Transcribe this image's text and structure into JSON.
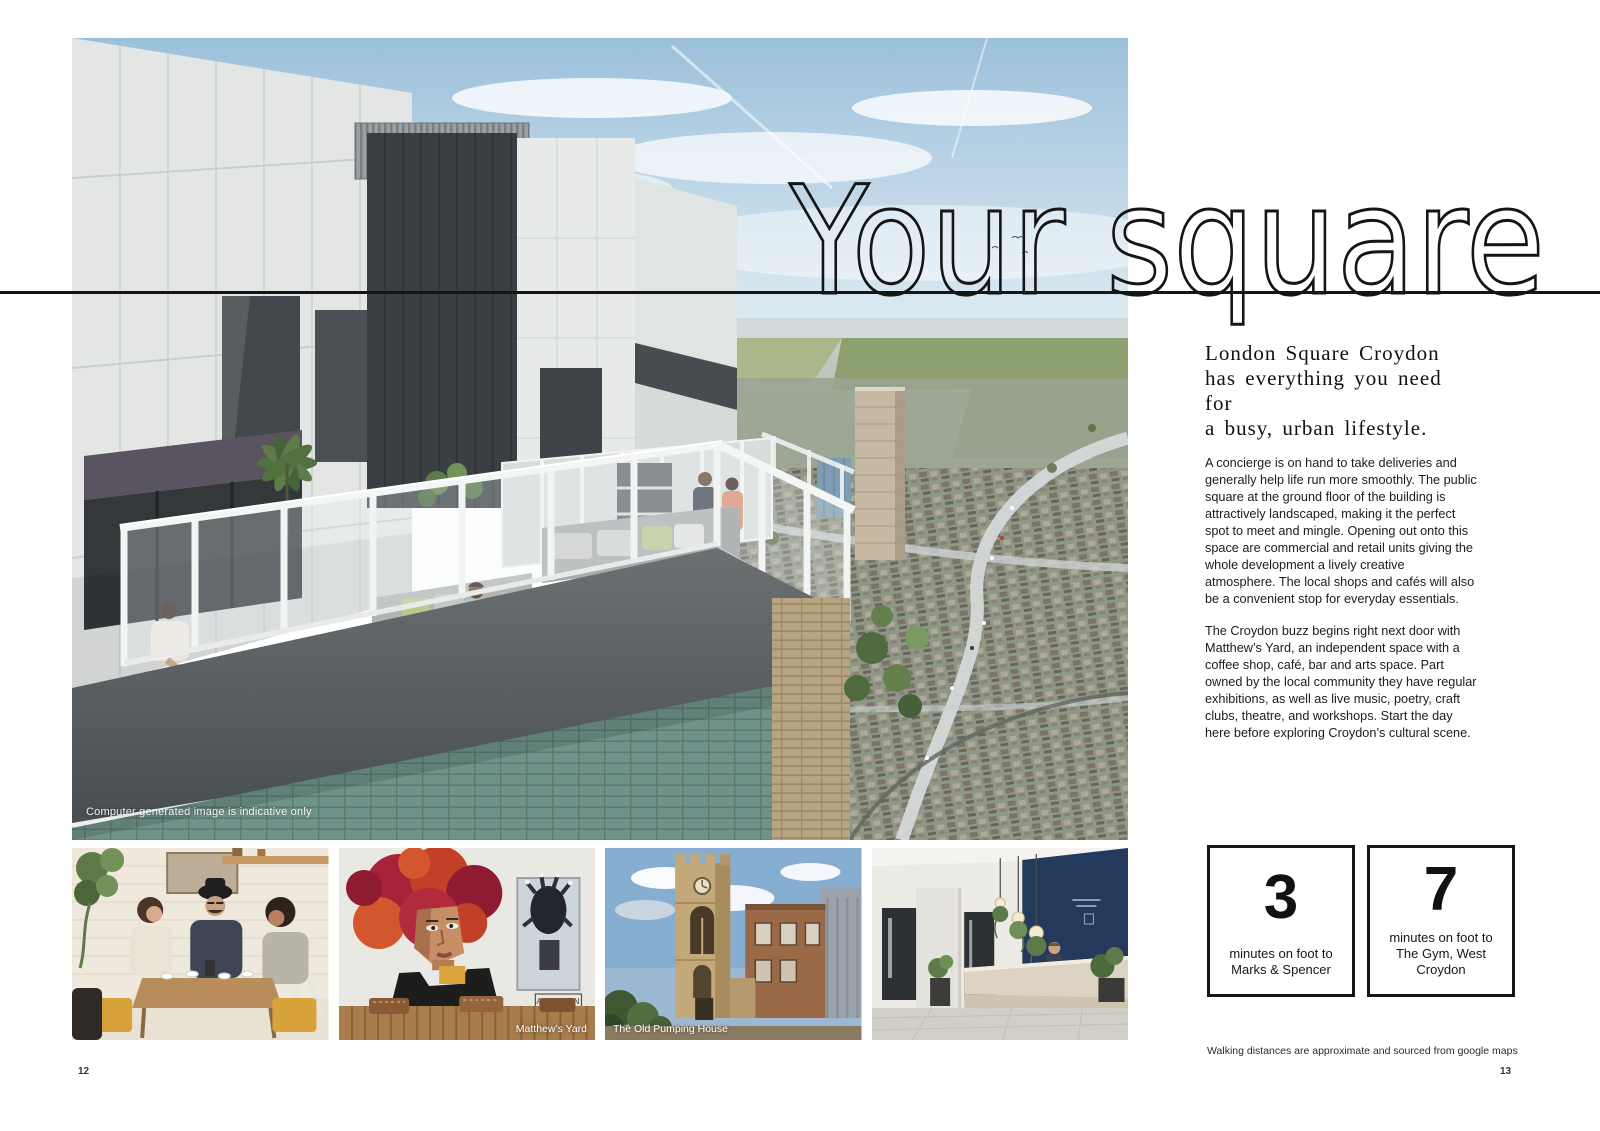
{
  "page": {
    "title": "Your square",
    "left_page_number": "12",
    "right_page_number": "13"
  },
  "hero": {
    "caption": "Computer generated image is indicative only"
  },
  "photos": {
    "mural_tag": "ALECLDN",
    "captions": [
      "",
      "Matthew’s Yard",
      "The Old Pumping House",
      ""
    ]
  },
  "article": {
    "heading_lines": [
      "London Square Croydon",
      "has everything you need for",
      "a busy, urban lifestyle."
    ],
    "paragraphs": [
      "A concierge is on hand to take deliveries and generally help life run more smoothly. The public square at the ground floor of the building is attractively landscaped, making it the perfect spot to meet and mingle. Opening out onto this space are commercial and retail units giving the whole development a lively creative atmosphere. The local shops and cafés will also be a convenient stop for everyday essentials.",
      "The Croydon buzz begins right next door with Matthew’s Yard, an independent space with a coffee shop, café, bar and arts space. Part owned by the local community they have regular exhibitions, as well as live music, poetry, craft clubs, theatre, and workshops. Start the day here before exploring Croydon’s cultural scene."
    ]
  },
  "stats": [
    {
      "value": "3",
      "line1": "minutes on foot to",
      "line2": "Marks & Spencer"
    },
    {
      "value": "7",
      "line1": "minutes on foot to",
      "line2": "The Gym, West Croydon"
    }
  ],
  "footnote": "Walking distances are approximate and sourced from google maps",
  "colors": {
    "ink": "#151515",
    "teal_brick": "#6f9289",
    "navy_wall": "#233a5c",
    "sky": "#9cc0db"
  }
}
